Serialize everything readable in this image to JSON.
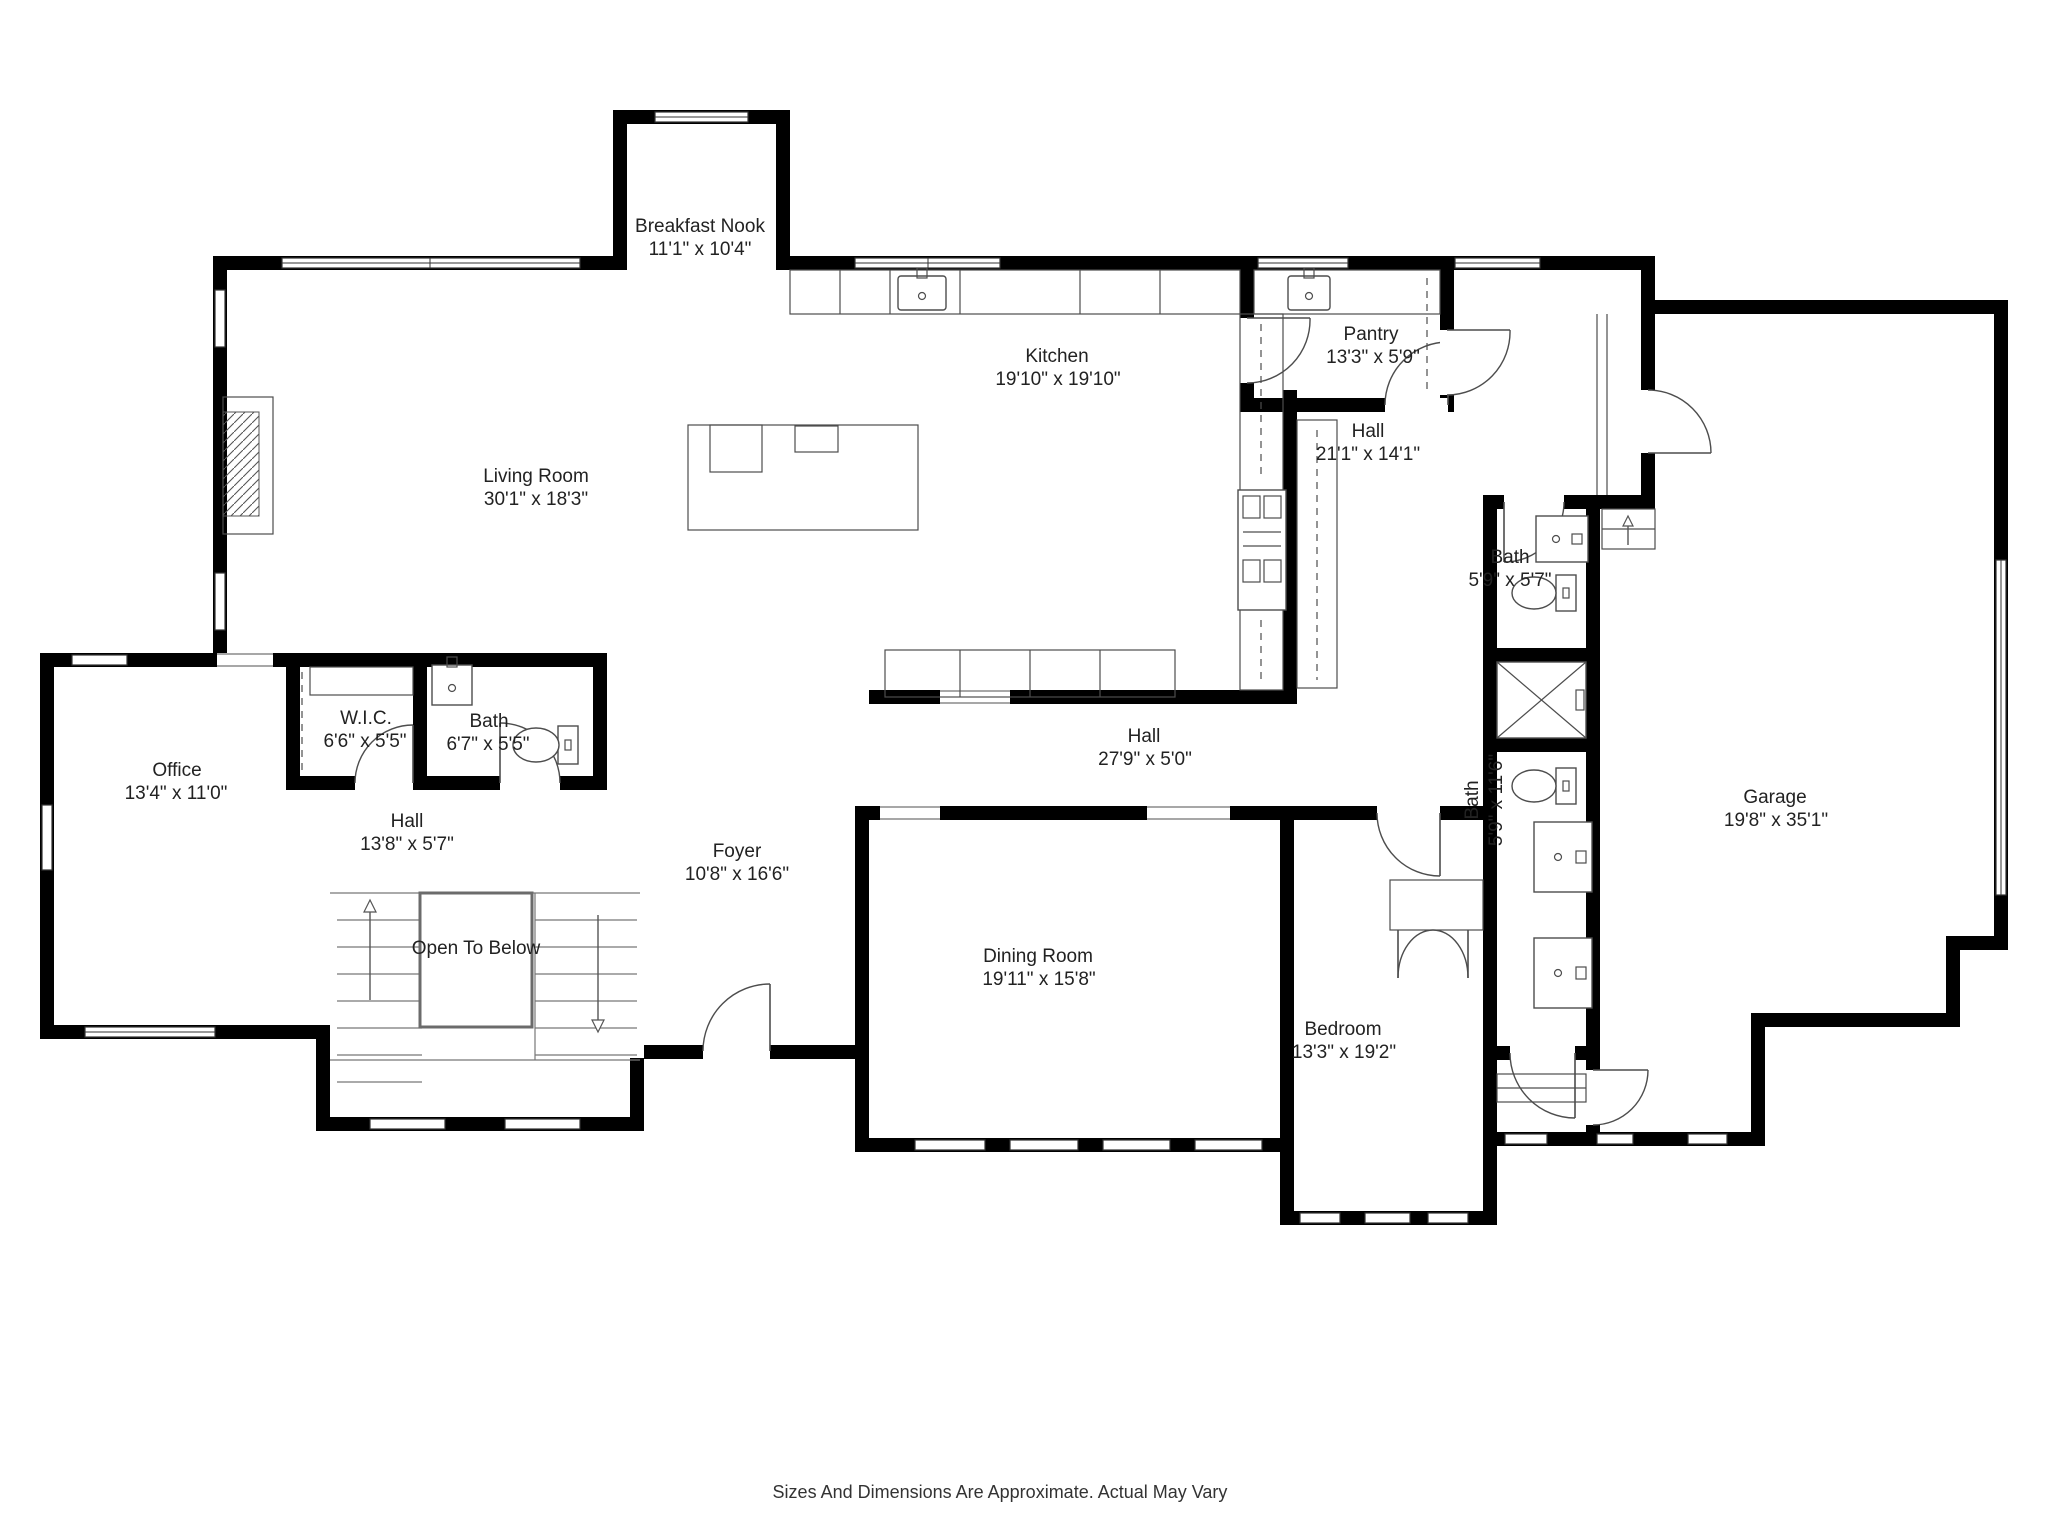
{
  "title": "First Floor Plan",
  "footer": "Sizes And Dimensions Are Approximate. Actual May Vary",
  "colors": {
    "wall": "#000000",
    "fixture_line": "#4d4d4d",
    "label": "#222222",
    "background": "#ffffff"
  },
  "rooms": [
    {
      "id": "breakfast-nook",
      "name": "Breakfast Nook",
      "dims": "11'1\" x 10'4\""
    },
    {
      "id": "living-room",
      "name": "Living Room",
      "dims": "30'1\" x 18'3\""
    },
    {
      "id": "kitchen",
      "name": "Kitchen",
      "dims": "19'10\" x 19'10\""
    },
    {
      "id": "pantry",
      "name": "Pantry",
      "dims": "13'3\" x 5'9\""
    },
    {
      "id": "hall-upper",
      "name": "Hall",
      "dims": "21'1\" x 14'1\""
    },
    {
      "id": "bath-small",
      "name": "Bath",
      "dims": "5'9\" x 5'7\""
    },
    {
      "id": "bath-long",
      "name": "Bath",
      "dims": "5'9\" x 11'6\""
    },
    {
      "id": "garage",
      "name": "Garage",
      "dims": "19'8\" x 35'1\""
    },
    {
      "id": "office",
      "name": "Office",
      "dims": "13'4\" x 11'0\""
    },
    {
      "id": "wic",
      "name": "W.I.C.",
      "dims": "6'6\" x 5'5\""
    },
    {
      "id": "bath-left",
      "name": "Bath",
      "dims": "6'7\" x 5'5\""
    },
    {
      "id": "hall-left",
      "name": "Hall",
      "dims": "13'8\" x 5'7\""
    },
    {
      "id": "foyer",
      "name": "Foyer",
      "dims": "10'8\" x 16'6\""
    },
    {
      "id": "open-to-below",
      "name": "Open To Below",
      "dims": ""
    },
    {
      "id": "hall-center",
      "name": "Hall",
      "dims": "27'9\" x 5'0\""
    },
    {
      "id": "dining-room",
      "name": "Dining Room",
      "dims": "19'11\" x 15'8\""
    },
    {
      "id": "bedroom",
      "name": "Bedroom",
      "dims": "13'3\" x 19'2\""
    }
  ]
}
